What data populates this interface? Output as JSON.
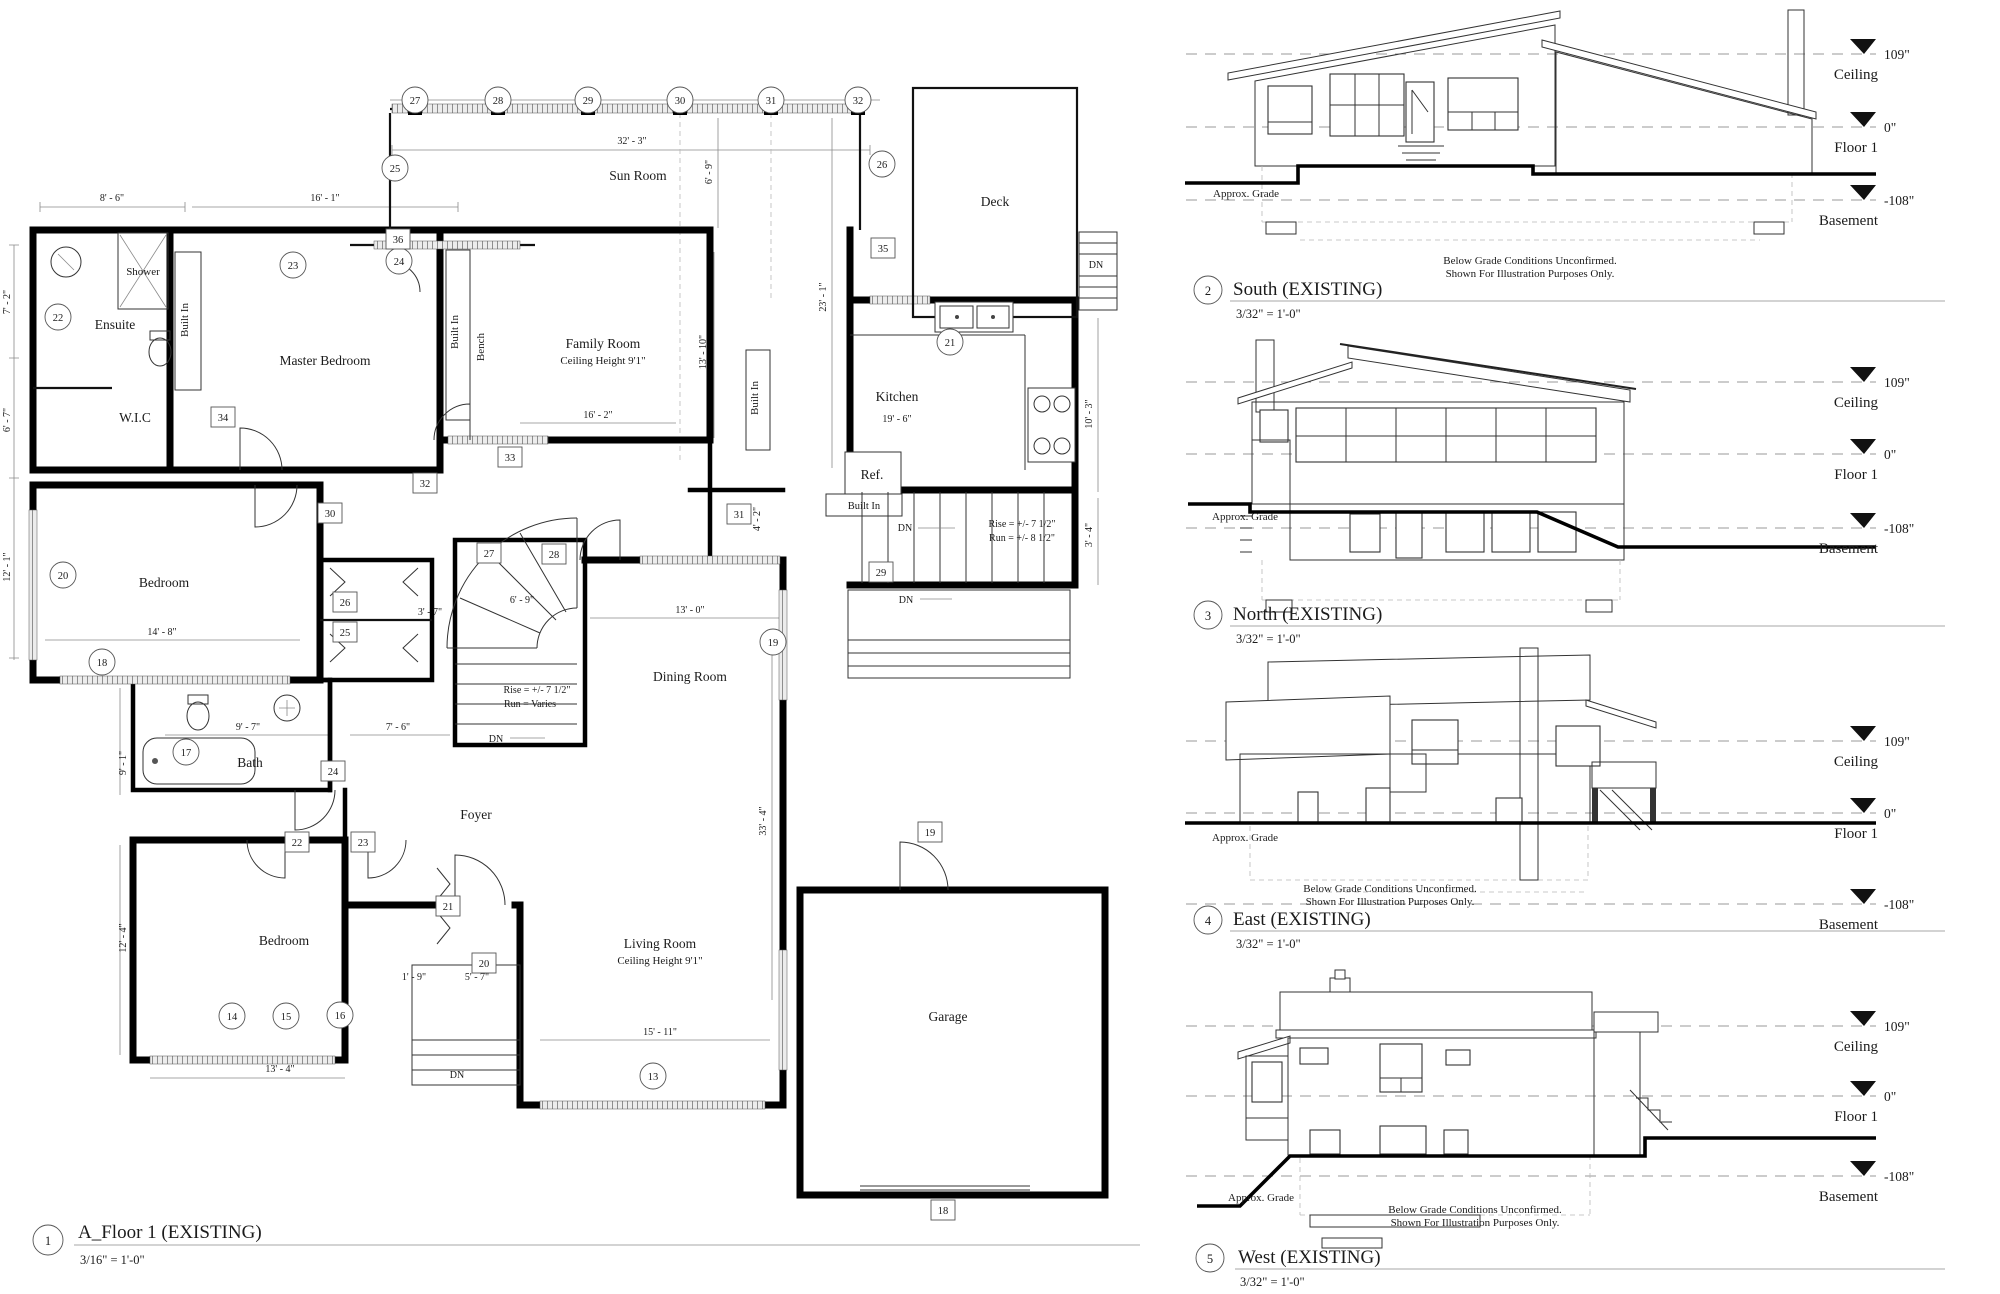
{
  "sheet": {
    "background": "#ffffff",
    "line_color": "#000000"
  },
  "plan": {
    "number": "1",
    "title": "A_Floor 1 (EXISTING)",
    "scale": "3/16\" = 1'-0\"",
    "rooms": {
      "ensuite": "Ensuite",
      "shower": "Shower",
      "wic": "W.I.C",
      "master_bedroom": "Master Bedroom",
      "sun_room": "Sun Room",
      "family_room": "Family Room",
      "ceiling_height": "Ceiling Height 9'1\"",
      "kitchen": "Kitchen",
      "deck": "Deck",
      "dining_room": "Dining Room",
      "bedroom": "Bedroom",
      "bath": "Bath",
      "foyer": "Foyer",
      "living_room": "Living Room",
      "garage": "Garage"
    },
    "labels": {
      "built_in": "Built In",
      "bench": "Bench",
      "ref": "Ref.",
      "dn": "DN"
    },
    "stair_notes": {
      "rise": "Rise = +/- 7 1/2\"",
      "run_varies": "Run = Varies",
      "run_kitchen": "Run = +/- 8 1/2\""
    },
    "grid_markers": [
      "27",
      "28",
      "29",
      "30",
      "31",
      "32"
    ],
    "circle_markers": [
      "25",
      "26",
      "22",
      "23",
      "24",
      "21",
      "20",
      "18",
      "17",
      "19",
      "14",
      "15",
      "16",
      "13"
    ],
    "box_markers": [
      "36",
      "34",
      "32",
      "33",
      "30",
      "26",
      "25",
      "27",
      "28",
      "31",
      "29",
      "24",
      "22",
      "23",
      "21",
      "20",
      "19",
      "18",
      "35"
    ],
    "dims": [
      "8' - 6\"",
      "16' - 1\"",
      "32' - 3\"",
      "6' - 9\"",
      "23' - 1\"",
      "13' - 10\"",
      "16' - 2\"",
      "19' - 6\"",
      "10' - 3\"",
      "3' - 4\"",
      "4' - 2\"",
      "13' - 0\"",
      "3' - 7\"",
      "14' - 8\"",
      "6' - 9\"",
      "9' - 7\"",
      "7' - 6\"",
      "9' - 1\"",
      "12' - 4\"",
      "13' - 4\"",
      "5' - 7\"",
      "1' - 9\"",
      "15' - 11\"",
      "33' - 4\"",
      "7' - 2\"",
      "6' - 7\"",
      "12' - 1\""
    ]
  },
  "levels": {
    "ceiling_label": "Ceiling",
    "ceiling_value": "109\"",
    "floor_label": "Floor 1",
    "floor_value": "0\"",
    "basement_label": "Basement",
    "basement_value": "-108\""
  },
  "elevations": [
    {
      "number": "2",
      "title": "South (EXISTING)",
      "scale": "3/32\" = 1'-0\"",
      "grade_label": "Approx. Grade",
      "note_line1": "Below Grade Conditions Unconfirmed.",
      "note_line2": "Shown For Illustration Purposes Only."
    },
    {
      "number": "3",
      "title": "North (EXISTING)",
      "scale": "3/32\" = 1'-0\"",
      "grade_label": "Approx. Grade"
    },
    {
      "number": "4",
      "title": "East (EXISTING)",
      "scale": "3/32\" = 1'-0\"",
      "grade_label": "Approx. Grade",
      "note_line1": "Below Grade Conditions Unconfirmed.",
      "note_line2": "Shown For Illustration Purposes Only."
    },
    {
      "number": "5",
      "title": "West (EXISTING)",
      "scale": "3/32\" = 1'-0\"",
      "grade_label": "Approx. Grade",
      "note_line1": "Below Grade Conditions Unconfirmed.",
      "note_line2": "Shown For Illustration Purposes Only."
    }
  ]
}
